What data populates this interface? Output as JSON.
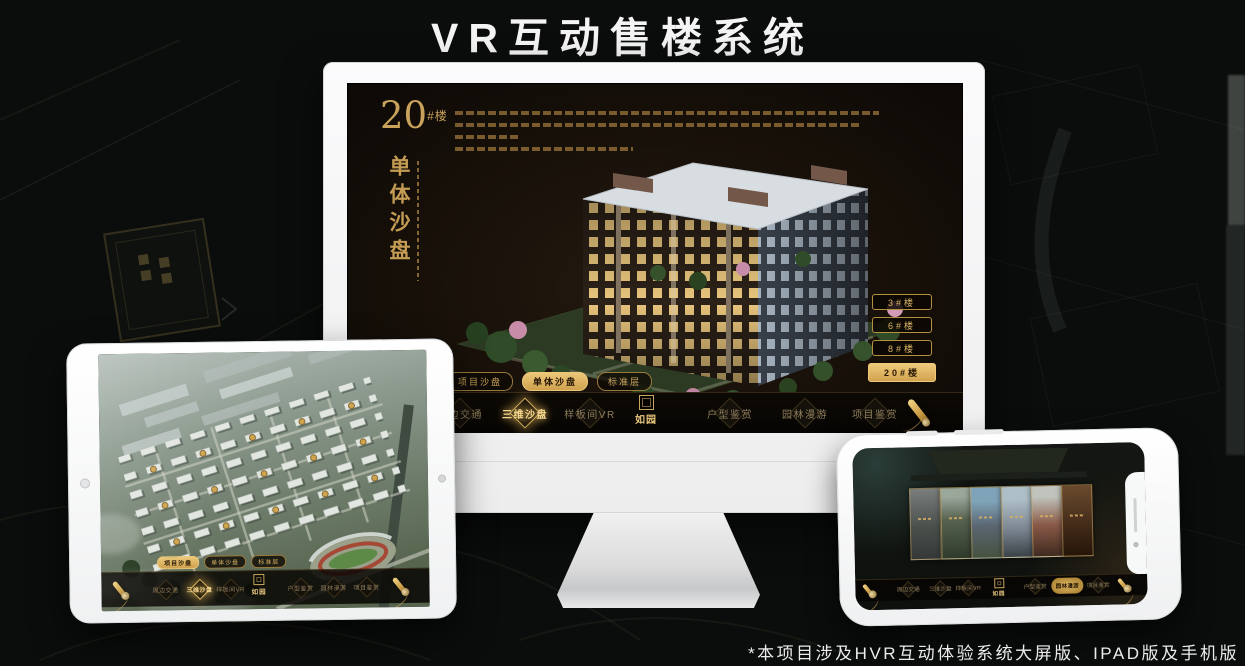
{
  "poster": {
    "title": "VR互动售楼系统",
    "footnote": "*本项目涉及HVR互动体验系统大屏版、IPAD版及手机版"
  },
  "colors": {
    "gold_accent": "#d0a85c",
    "gold_selected": "#ecc878",
    "selected_text": "#2a1a05",
    "screen_background": "#171009",
    "canvas_background": "#0a0d0b",
    "title_text": "#f4f4f4"
  },
  "nav": {
    "logo": "如园",
    "items": [
      "周边交通",
      "三维沙盘",
      "样板间VR",
      "户型鉴赏",
      "园林漫游",
      "项目鉴赏"
    ]
  },
  "mode_tabs": [
    "项目沙盘",
    "单体沙盘",
    "标准层"
  ],
  "monitor_app": {
    "heading_number": "20",
    "heading_unit": "#楼",
    "heading_vertical": "单体沙盘",
    "selected_mode_tab": "单体沙盘",
    "active_nav_item": "三维沙盘",
    "building_buttons": [
      "3#楼",
      "6#楼",
      "8#楼",
      "20#楼"
    ],
    "selected_building": "20#楼"
  },
  "tablet_app": {
    "selected_mode_tab": "项目沙盘",
    "active_nav_item": "三维沙盘"
  },
  "phone_app": {
    "active_nav_item": "园林漫游"
  }
}
